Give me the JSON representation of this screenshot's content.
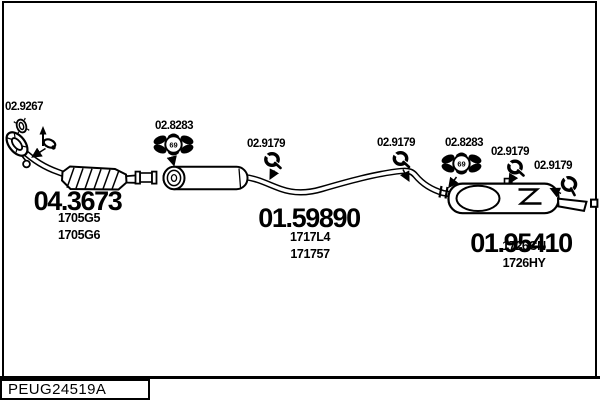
{
  "colors": {
    "ink": "#000000",
    "paper": "#ffffff"
  },
  "footer": {
    "reference": "PEUG24519A"
  },
  "parts": {
    "front_clamp": {
      "ref": "02.9267"
    },
    "catalyst_section": {
      "number": "04.3673",
      "oe1": "1705G5",
      "oe2": "1705G6"
    },
    "mount_left": {
      "ref": "02.8283",
      "badge": "69"
    },
    "hanger_1": {
      "ref": "02.9179"
    },
    "centre_silencer": {
      "number": "01.59890",
      "oe1": "1717L4",
      "oe2": "171757"
    },
    "hanger_2": {
      "ref": "02.9179"
    },
    "mount_right": {
      "ref": "02.8283",
      "badge": "69"
    },
    "hanger_3": {
      "ref": "02.9179"
    },
    "hanger_4": {
      "ref": "02.9179"
    },
    "rear_silencer": {
      "number": "01.95410",
      "oe1": "1726CN",
      "oe2": "1726HY"
    }
  }
}
